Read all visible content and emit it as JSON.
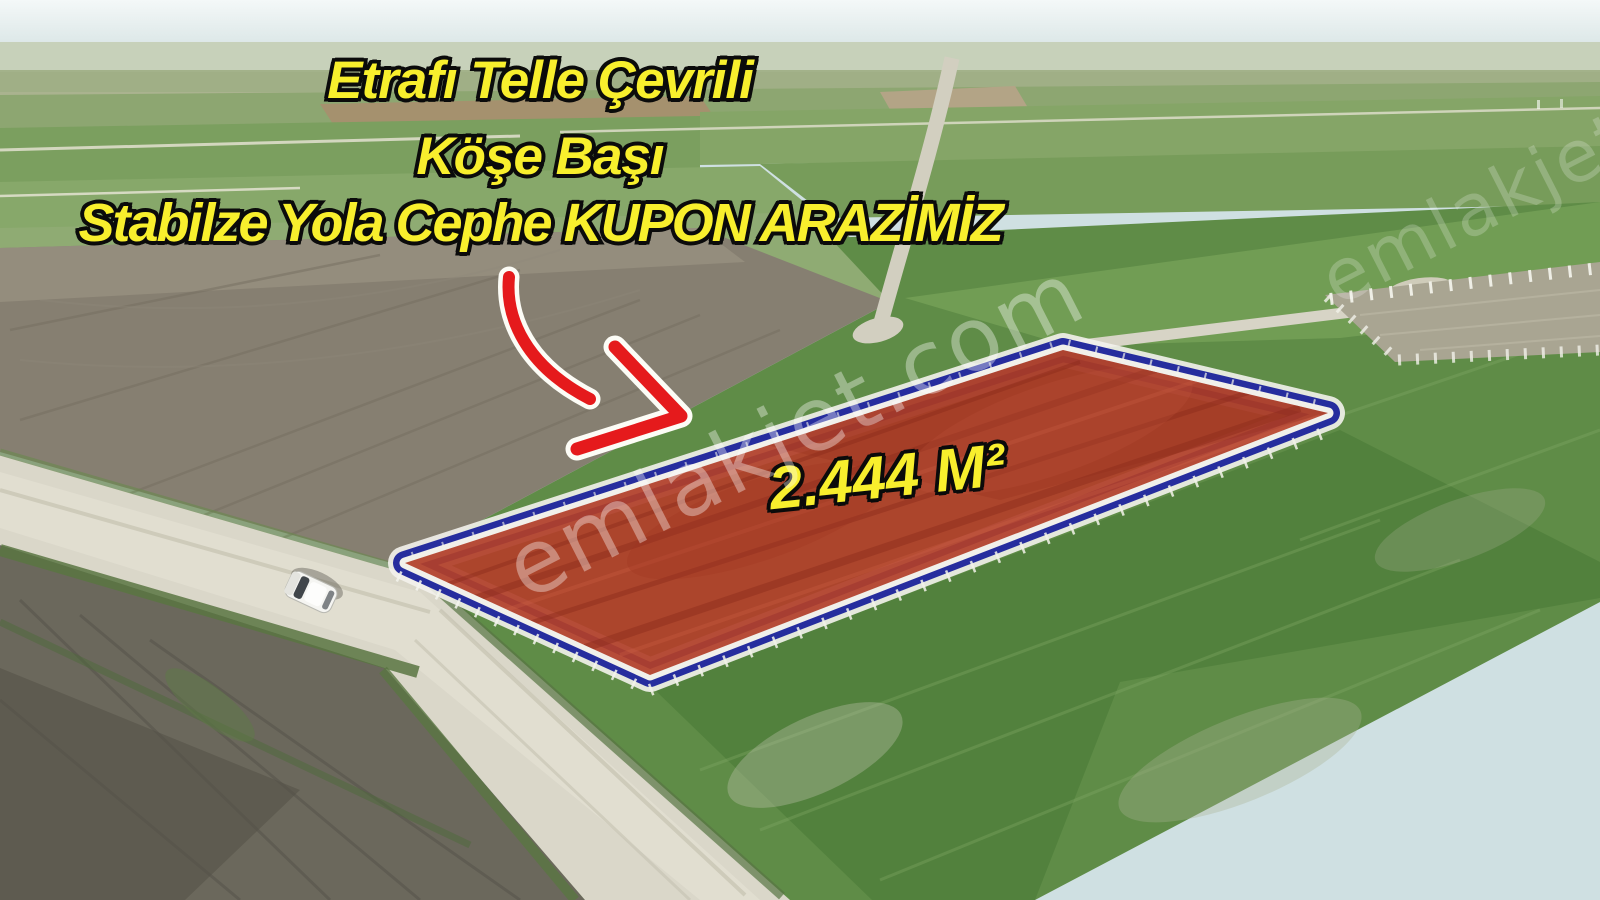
{
  "annotations": {
    "caption_lines": [
      "Etrafı Telle Çevrili",
      "Köşe Başı",
      "Stabilze Yola Cephe KUPON ARAZİMİZ"
    ],
    "area_label": "2.444 M²",
    "text_color": "#f8ef2d",
    "text_outline_color": "#0b0b0b",
    "arrow": {
      "fill": "#e51a1c",
      "outline": "#fcfcf6"
    }
  },
  "plot_overlay": {
    "fill_color": "#b2402a",
    "border_color": "#262d9e",
    "inner_line_color": "#f1f0ea",
    "outer_line_color": "#f3f2ec"
  },
  "watermark": {
    "text": "emlakjet.com"
  },
  "scene_icons": {
    "arrow": "curved-red-arrow",
    "car": "white-car",
    "plot": "highlighted-land-plot",
    "watermark": "emlakjet-watermark"
  }
}
